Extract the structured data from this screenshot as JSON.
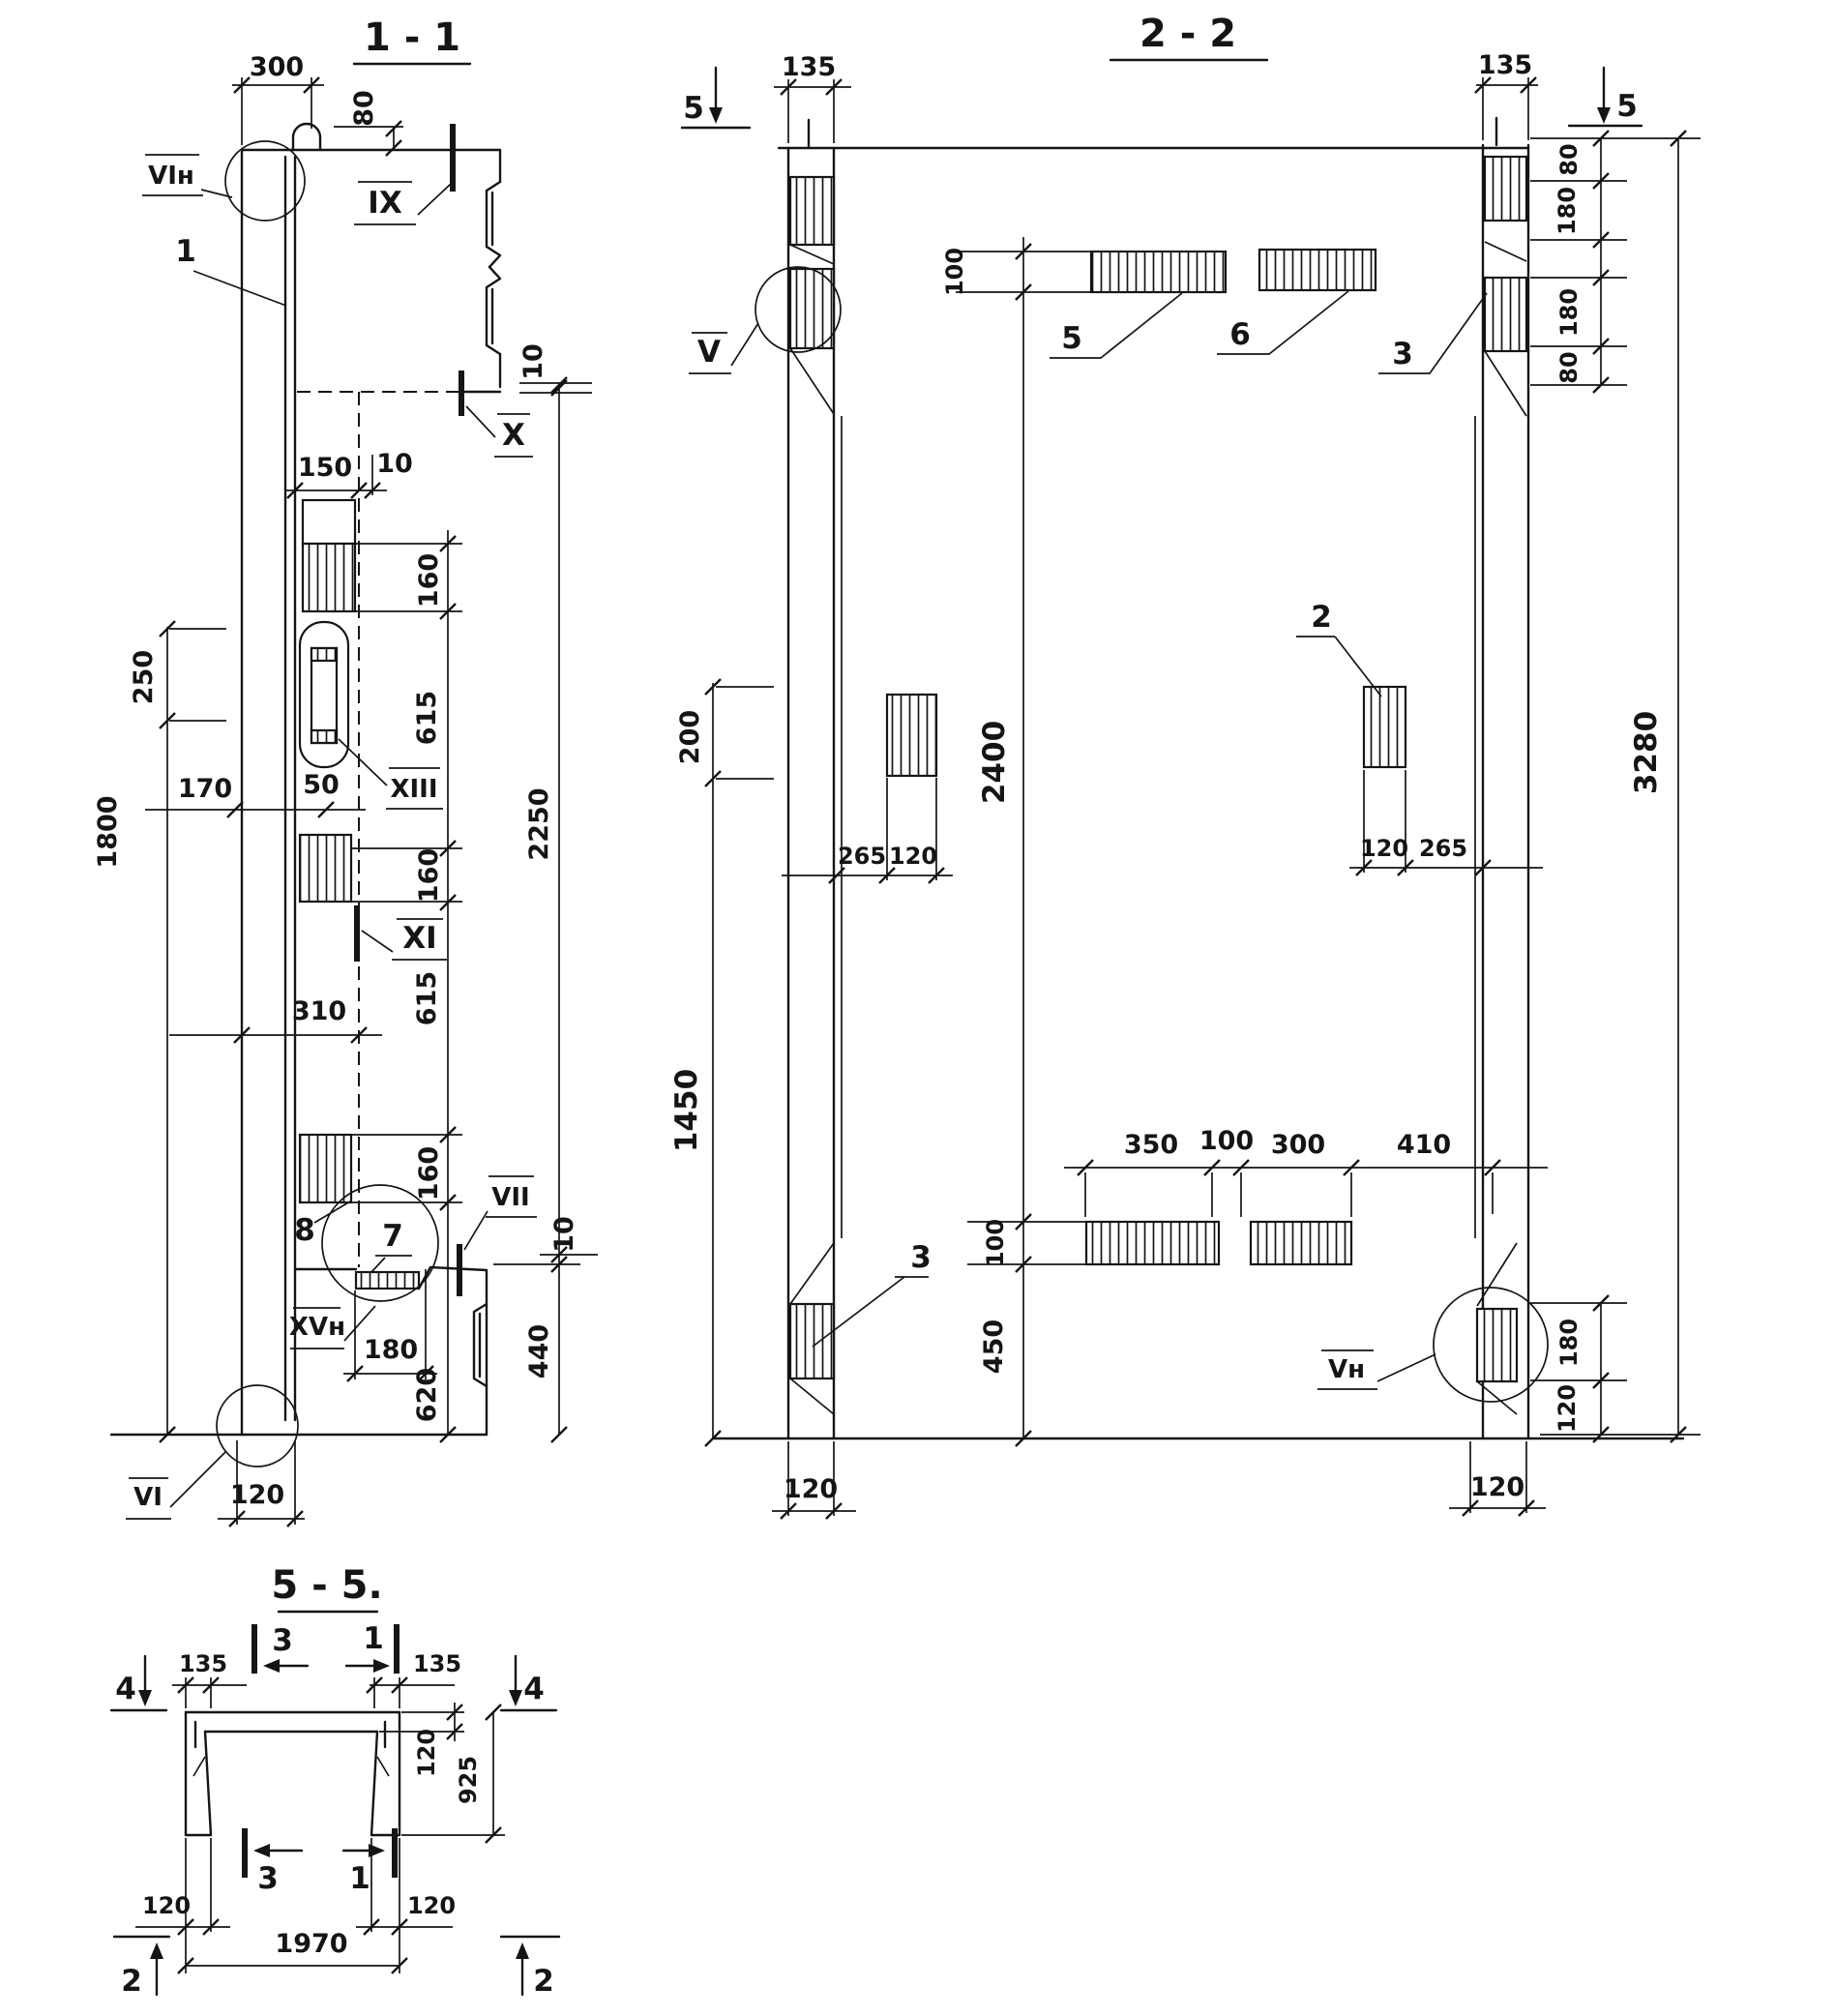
{
  "sheet": {
    "description": "Reinforced concrete channel panel working drawing, three sections"
  },
  "v11": {
    "title": "1 - 1",
    "d300": "300",
    "d80": "80",
    "lbl_vi_n": "VIн",
    "lbl_1": "1",
    "lbl_ix": "IX",
    "lbl_x": "X",
    "d10_top": "10",
    "d150": "150",
    "d10_web": "10",
    "d160_a": "160",
    "d615_a": "615",
    "lbl_xiii": "XIII",
    "d250": "250",
    "d170": "170",
    "d50": "50",
    "d160_b": "160",
    "lbl_xi": "XI",
    "d310": "310",
    "d615_b": "615",
    "d1800": "1800",
    "d2250": "2250",
    "d160_c": "160",
    "lbl_8": "8",
    "lbl_7": "7",
    "lbl_vii": "VII",
    "d10_bot": "10",
    "lbl_xv_n": "XVн",
    "d180": "180",
    "d620": "620",
    "d440": "440",
    "lbl_vi": "VI",
    "d120": "120"
  },
  "v22": {
    "title": "2 - 2",
    "sec5_left": "5",
    "sec5_right": "5",
    "d135_l": "135",
    "d135_r": "135",
    "d80_t1": "80",
    "d180_t1": "180",
    "d180_t2": "180",
    "d80_t2": "80",
    "d3280": "3280",
    "d100_top": "100",
    "lbl_5": "5",
    "lbl_6": "6",
    "lbl_3_top": "3",
    "lbl_v": "V",
    "d200": "200",
    "d2400": "2400",
    "d265_l": "265",
    "d120_l": "120",
    "lbl_2": "2",
    "d120_r": "120",
    "d265_r": "265",
    "d1450": "1450",
    "d350": "350",
    "d100_mid": "100",
    "d300": "300",
    "d410": "410",
    "d100_b": "100",
    "d450": "450",
    "lbl_3_bot": "3",
    "lbl_v_n": "Vн",
    "d180_b": "180",
    "d120_b": "120",
    "d120_bl": "120",
    "d120_br": "120"
  },
  "v55": {
    "title": "5 - 5.",
    "lbl_4_l": "4",
    "lbl_4_r": "4",
    "d135_l": "135",
    "d135_r": "135",
    "lbl_3_t": "3",
    "lbl_1_t": "1",
    "lbl_3_b": "3",
    "lbl_1_b": "1",
    "d120_slab": "120",
    "d925": "925",
    "d120_bl": "120",
    "d120_br": "120",
    "d1970": "1970",
    "lbl_2_l": "2",
    "lbl_2_r": "2"
  }
}
